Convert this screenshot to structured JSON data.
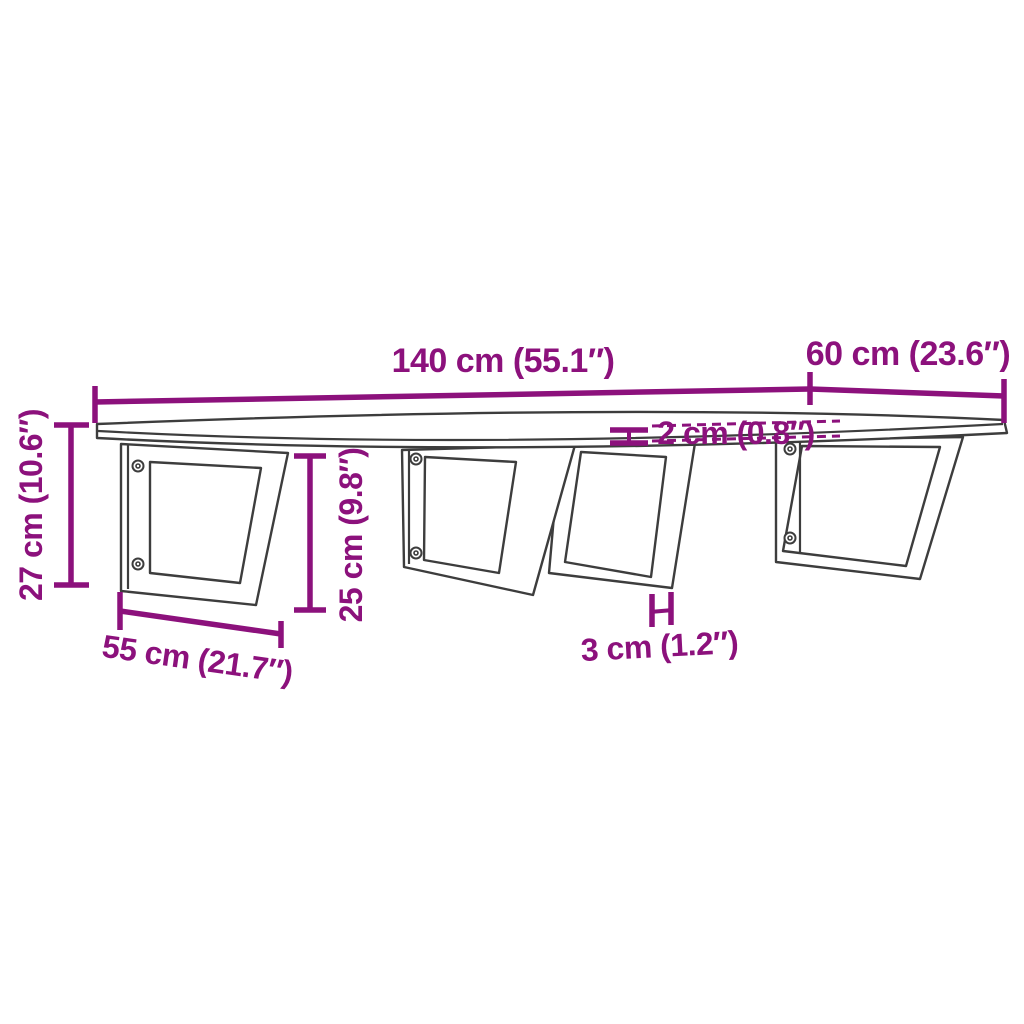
{
  "diagram": {
    "type": "product-dimension-drawing",
    "subject": "wall-mounted shelf board with four steel brackets",
    "colors": {
      "dimension_accent": "#8C117C",
      "drawing_outline": "#3D3D3D",
      "background": "#FFFFFF"
    },
    "labels": {
      "length": "140 cm (55.1″)",
      "depth": "60 cm (23.6″)",
      "total_height": "27 cm (10.6″)",
      "bracket_height": "25 cm (9.8″)",
      "bracket_depth": "55 cm (21.7″)",
      "board_thickness": "2 cm (0.8″)",
      "bar_width": "3 cm (1.2″)"
    }
  }
}
